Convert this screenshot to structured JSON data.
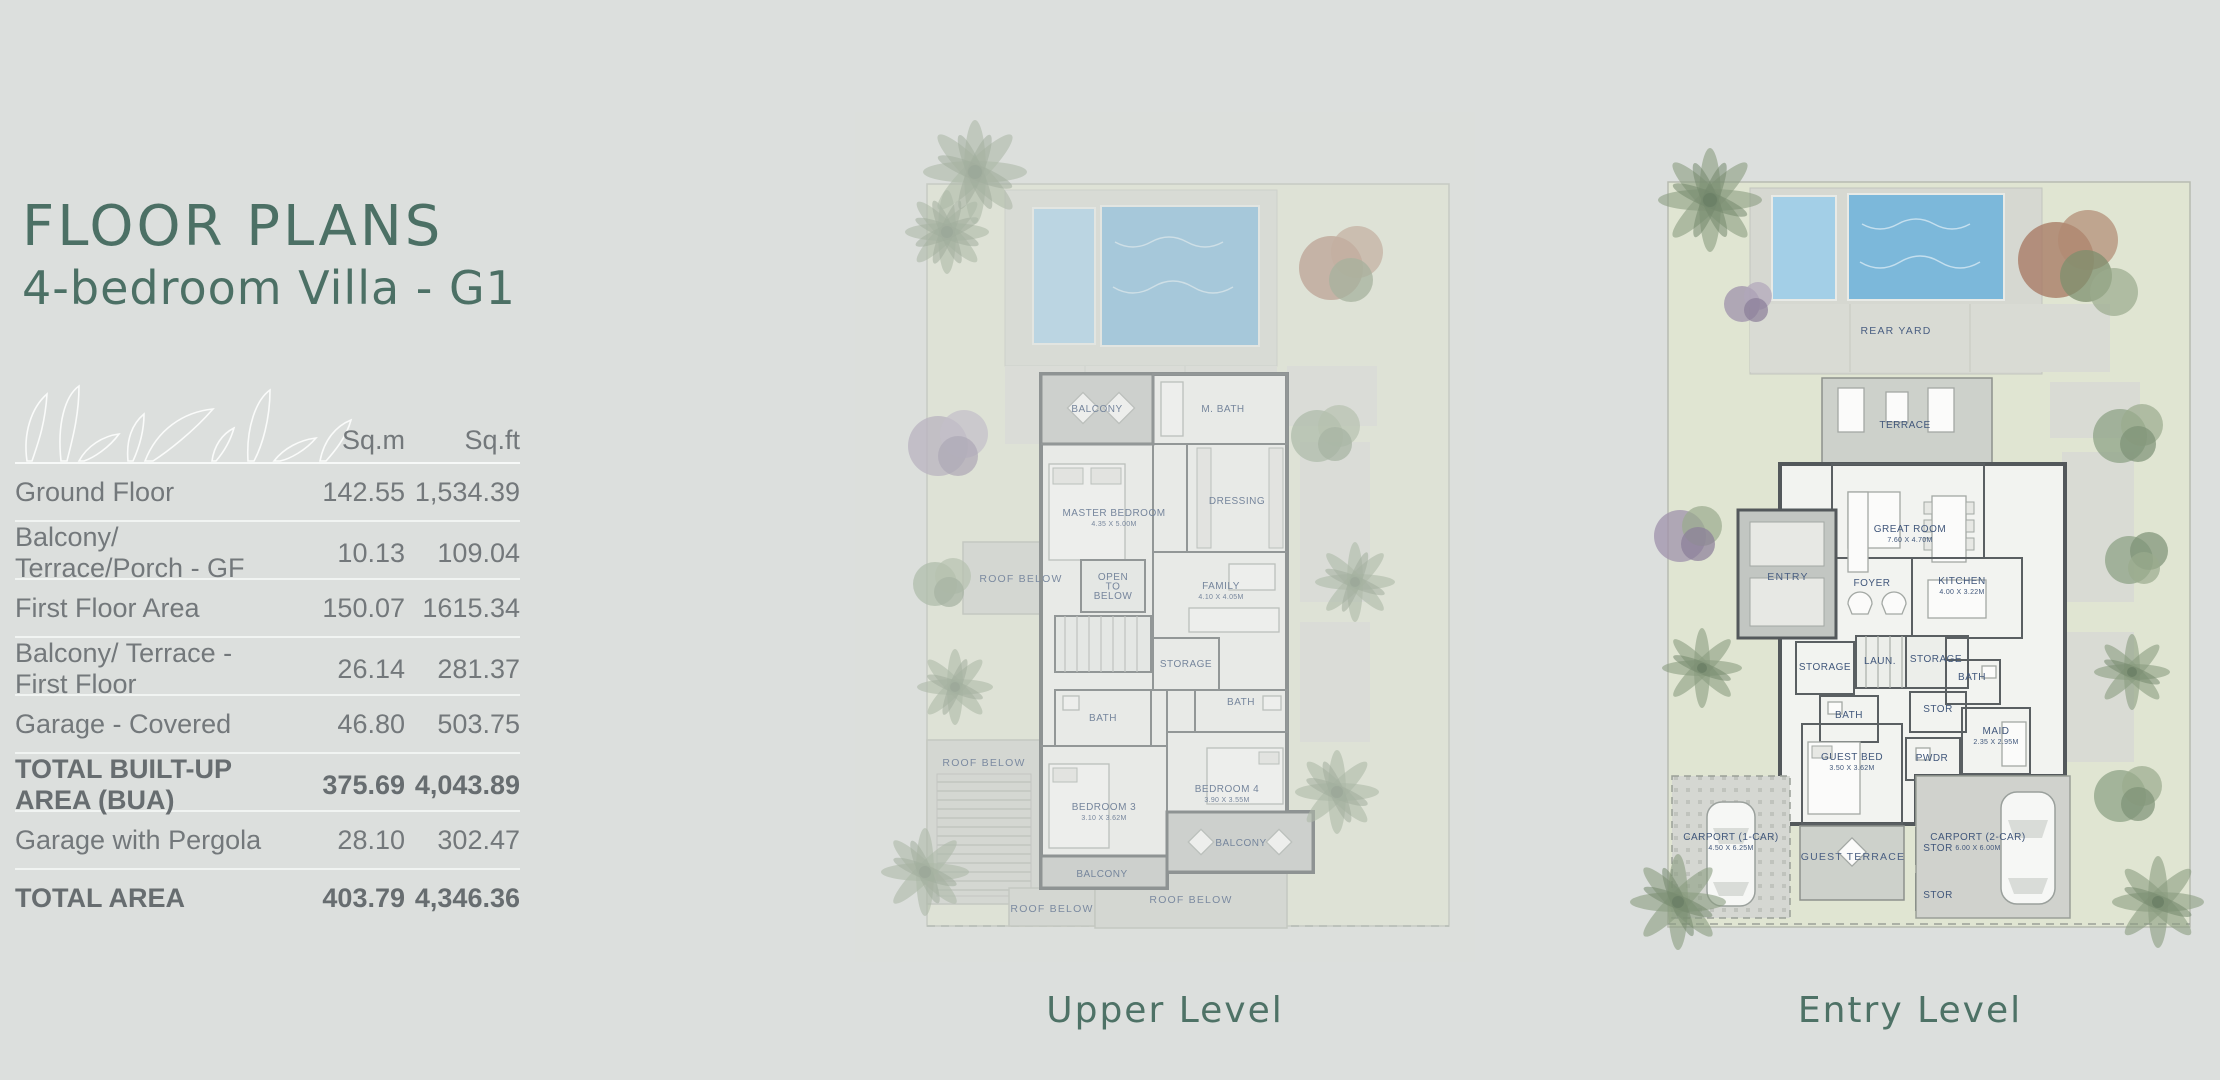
{
  "header": {
    "title": "FLOOR PLANS",
    "subtitle": "4-bedroom Villa - G1"
  },
  "colors": {
    "background": "#dcdfdd",
    "accent_green": "#4c7065",
    "table_text": "#73787b",
    "divider": "#f1f4f2",
    "pool_blue": "#7cb8da",
    "garden_green": "#e0e5d2",
    "room_label_blue": "#41577b"
  },
  "area_table": {
    "columns": [
      "Sq.m",
      "Sq.ft"
    ],
    "rows": [
      {
        "label": "Ground Floor",
        "sqm": "142.55",
        "sqft": "1,534.39",
        "bold": false
      },
      {
        "label": "Balcony/ Terrace/Porch - GF",
        "sqm": "10.13",
        "sqft": "109.04",
        "bold": false
      },
      {
        "label": "First Floor Area",
        "sqm": "150.07",
        "sqft": "1615.34",
        "bold": false
      },
      {
        "label": "Balcony/ Terrace - First Floor",
        "sqm": "26.14",
        "sqft": "281.37",
        "bold": false
      },
      {
        "label": "Garage - Covered",
        "sqm": "46.80",
        "sqft": "503.75",
        "bold": false
      },
      {
        "label": "TOTAL BUILT-UP AREA (BUA)",
        "sqm": "375.69",
        "sqft": "4,043.89",
        "bold": true
      },
      {
        "label": "Garage with Pergola",
        "sqm": "28.10",
        "sqft": "302.47",
        "bold": false
      },
      {
        "label": "TOTAL AREA",
        "sqm": "403.79",
        "sqft": "4,346.36",
        "bold": true
      }
    ]
  },
  "plans": [
    {
      "caption": "Upper Level",
      "labels": [
        {
          "text": "BALCONY",
          "x": 242,
          "y": 300
        },
        {
          "text": "M. BATH",
          "x": 368,
          "y": 300
        },
        {
          "text": "MASTER BEDROOM",
          "dim": "4.35 X 5.00M",
          "x": 259,
          "y": 404
        },
        {
          "text": "DRESSING",
          "x": 382,
          "y": 392
        },
        {
          "text": "ROOF BELOW",
          "x": 166,
          "y": 470,
          "cls": "roof"
        },
        {
          "text": "OPEN\nTO\nBELOW",
          "x": 258,
          "y": 468
        },
        {
          "text": "FAMILY",
          "dim": "4.10 X 4.05M",
          "x": 366,
          "y": 477
        },
        {
          "text": "STORAGE",
          "x": 331,
          "y": 555
        },
        {
          "text": "BATH",
          "x": 386,
          "y": 593
        },
        {
          "text": "BATH",
          "x": 248,
          "y": 609
        },
        {
          "text": "BEDROOM 3",
          "dim": "3.10 X 3.62M",
          "x": 249,
          "y": 698
        },
        {
          "text": "BEDROOM 4",
          "dim": "3.90 X 3.55M",
          "x": 372,
          "y": 680
        },
        {
          "text": "BALCONY",
          "x": 247,
          "y": 765
        },
        {
          "text": "BALCONY",
          "x": 386,
          "y": 734
        },
        {
          "text": "ROOF BELOW",
          "x": 129,
          "y": 654,
          "cls": "roof"
        },
        {
          "text": "ROOF BELOW",
          "x": 197,
          "y": 800,
          "cls": "roof"
        },
        {
          "text": "ROOF BELOW",
          "x": 336,
          "y": 791,
          "cls": "roof"
        }
      ]
    },
    {
      "caption": "Entry Level",
      "labels": [
        {
          "text": "REAR YARD",
          "x": 286,
          "y": 222,
          "cls": "roof"
        },
        {
          "text": "TERRACE",
          "x": 295,
          "y": 316
        },
        {
          "text": "GREAT ROOM",
          "dim": "7.60 X 4.70M",
          "x": 300,
          "y": 420
        },
        {
          "text": "ENTRY",
          "x": 178,
          "y": 468,
          "cls": "roof"
        },
        {
          "text": "FOYER",
          "x": 262,
          "y": 474
        },
        {
          "text": "KITCHEN",
          "dim": "4.00 X 3.22M",
          "x": 352,
          "y": 472
        },
        {
          "text": "STORAGE",
          "x": 215,
          "y": 558
        },
        {
          "text": "LAUN.",
          "x": 270,
          "y": 552
        },
        {
          "text": "STORAGE",
          "x": 326,
          "y": 550
        },
        {
          "text": "BATH",
          "x": 362,
          "y": 568
        },
        {
          "text": "STOR",
          "x": 328,
          "y": 600
        },
        {
          "text": "BATH",
          "x": 239,
          "y": 606
        },
        {
          "text": "MAID",
          "dim": "2.35 X 2.95M",
          "x": 386,
          "y": 622
        },
        {
          "text": "GUEST BED",
          "dim": "3.50 X 3.62M",
          "x": 242,
          "y": 648
        },
        {
          "text": "PWDR",
          "x": 322,
          "y": 649
        },
        {
          "text": "CARPORT (1-CAR)",
          "dim": "4.50 X 6.25M",
          "x": 121,
          "y": 728
        },
        {
          "text": "CARPORT (2-CAR)",
          "dim": "6.00 X 6.00M",
          "x": 368,
          "y": 728
        },
        {
          "text": "GUEST TERRACE",
          "x": 243,
          "y": 748,
          "cls": "roof"
        },
        {
          "text": "STOR",
          "x": 328,
          "y": 739
        },
        {
          "text": "STOR",
          "x": 328,
          "y": 786
        }
      ]
    }
  ]
}
